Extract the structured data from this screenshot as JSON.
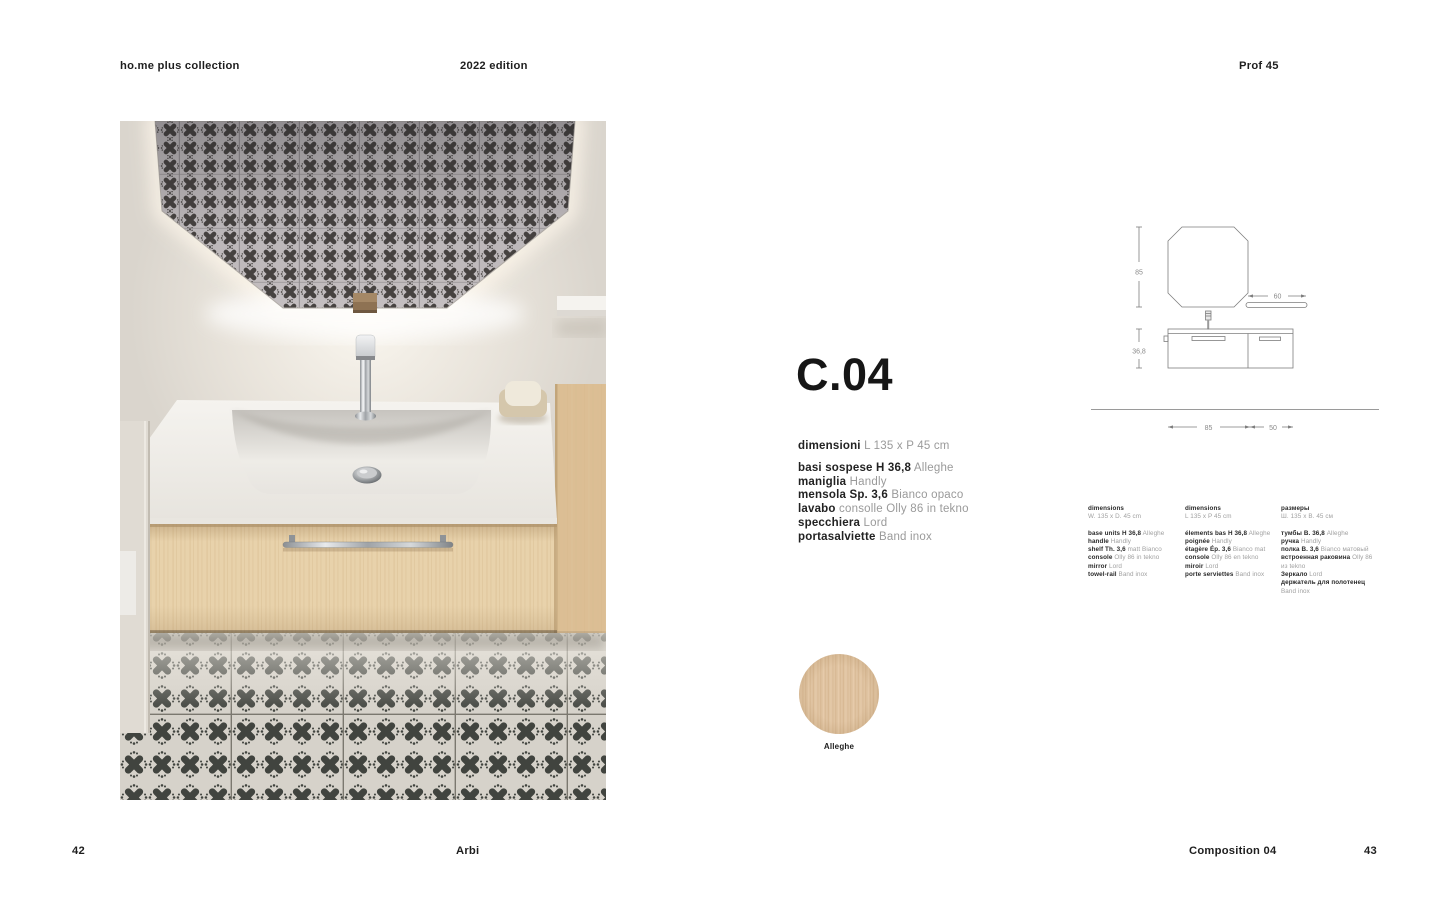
{
  "header": {
    "collection": "ho.me plus collection",
    "edition": "2022 edition",
    "profile": "Prof 45"
  },
  "product": {
    "code": "C.04",
    "dimensions_label": "dimensioni",
    "dimensions_value": "L 135 x P 45 cm",
    "specs": [
      {
        "label": "basi sospese H 36,8",
        "value": "Alleghe"
      },
      {
        "label": "maniglia",
        "value": "Handly"
      },
      {
        "label": "mensola Sp. 3,6",
        "value": "Bianco opaco"
      },
      {
        "label": "lavabo",
        "value": "consolle Olly 86 in tekno"
      },
      {
        "label": "specchiera",
        "value": "Lord"
      },
      {
        "label": "portasalviette",
        "value": "Band inox"
      }
    ]
  },
  "drawing": {
    "mirror_height": "85",
    "shelf_width": "60",
    "base_height": "36,8",
    "base_width_left": "85",
    "base_width_right": "50"
  },
  "spec_columns": [
    {
      "title": "dimensions",
      "subtitle": "W. 135 x D. 45 cm",
      "lines": [
        {
          "label": "base units H 36,8",
          "value": "Alleghe"
        },
        {
          "label": "handle",
          "value": "Handly"
        },
        {
          "label": "shelf Th. 3,6",
          "value": "matt Bianco"
        },
        {
          "label": "console",
          "value": "Olly 86 in tekno"
        },
        {
          "label": "mirror",
          "value": "Lord"
        },
        {
          "label": "towel-rail",
          "value": "Band inox"
        }
      ]
    },
    {
      "title": "dimensions",
      "subtitle": "L 135 x P 45 cm",
      "lines": [
        {
          "label": "élements bas H 36,8",
          "value": "Alleghe"
        },
        {
          "label": "poignée",
          "value": "Handly"
        },
        {
          "label": "étagère Ép. 3,6",
          "value": "Bianco mat"
        },
        {
          "label": "console",
          "value": "Olly 86 en tekno"
        },
        {
          "label": "miroir",
          "value": "Lord"
        },
        {
          "label": "porte serviettes",
          "value": "Band inox"
        }
      ]
    },
    {
      "title": "размеры",
      "subtitle": "Ш. 135 x В. 45 см",
      "lines": [
        {
          "label": "тумбы В. 36,8",
          "value": "Alleghe"
        },
        {
          "label": "ручка",
          "value": "Handly"
        },
        {
          "label": "полка В. 3,6",
          "value": "Bianco матовый"
        },
        {
          "label": "встроенная раковина",
          "value": "Olly 86 из tekno"
        },
        {
          "label": "Зеркало",
          "value": "Lord"
        },
        {
          "label": "держатель для полотенец",
          "value": "Band inox"
        }
      ]
    }
  ],
  "swatch": {
    "label": "Alleghe",
    "color": "#dec2a1"
  },
  "footer": {
    "page_left": "42",
    "brand": "Arbi",
    "composition": "Composition 04",
    "page_right": "43"
  },
  "colors": {
    "wall": "#dad5cd",
    "tile_light": "#d6d2ca",
    "tile_dark": "#45443f",
    "swatch_wood": "#dec2a1"
  }
}
